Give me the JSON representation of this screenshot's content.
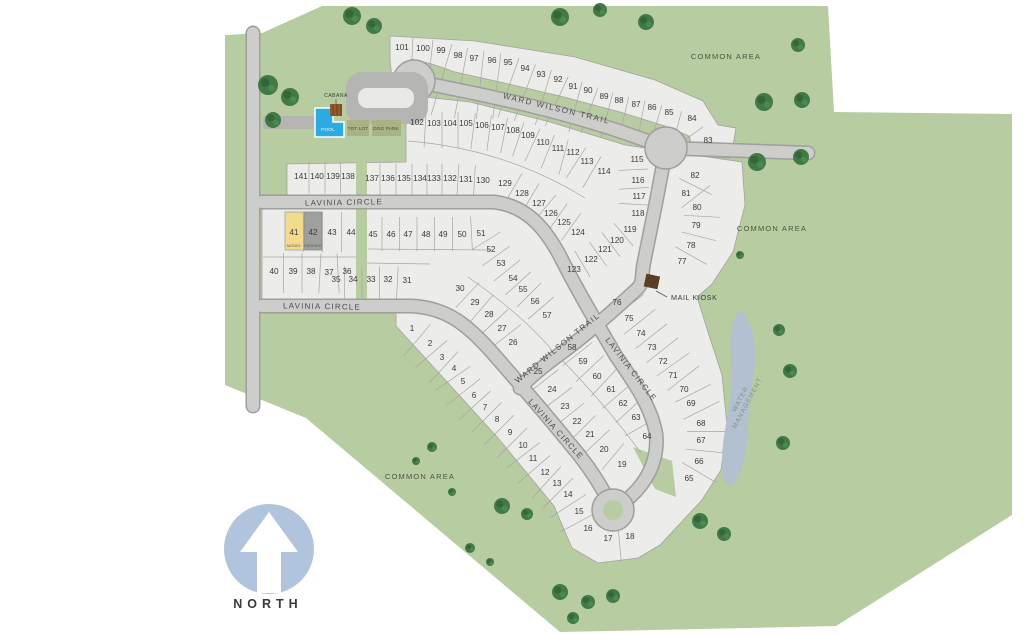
{
  "map": {
    "north_label": "NORTH",
    "streets": [
      {
        "id": "ward-wilson-trail-top",
        "text": "WARD WILSON TRAIL",
        "x": 556,
        "y": 111,
        "rot": 13.5,
        "size": 8,
        "ls": 1.6
      },
      {
        "id": "ward-wilson-trail-diagonal",
        "text": "WARD WILSON TRAIL",
        "x": 559,
        "y": 350,
        "rot": -39,
        "size": 8,
        "ls": 1.4
      },
      {
        "id": "lavinia-circle-upper",
        "text": "LAVINIA CIRCLE",
        "x": 344,
        "y": 205,
        "rot": -1,
        "size": 8,
        "ls": 1.2
      },
      {
        "id": "lavinia-circle-lower",
        "text": "LAVINIA CIRCLE",
        "x": 322,
        "y": 309,
        "rot": 1,
        "size": 8,
        "ls": 1.2
      },
      {
        "id": "lavinia-circle-southeast",
        "text": "LAVINIA CIRCLE",
        "x": 629,
        "y": 371,
        "rot": 52,
        "size": 8,
        "ls": 1.2
      },
      {
        "id": "lavinia-circle-southwest",
        "text": "LAVINIA CIRCLE",
        "x": 554,
        "y": 431,
        "rot": 48,
        "size": 8,
        "ls": 1.2
      }
    ],
    "areas": [
      {
        "id": "common-area-top-right",
        "text": "COMMON AREA",
        "x": 726,
        "y": 59,
        "size": 7.5,
        "ls": 1.2,
        "fill": "#4d553f"
      },
      {
        "id": "common-area-right",
        "text": "COMMON AREA",
        "x": 772,
        "y": 231,
        "size": 7.5,
        "ls": 1.2,
        "fill": "#4d553f"
      },
      {
        "id": "common-area-bottom-left",
        "text": "COMMON AREA",
        "x": 420,
        "y": 479,
        "size": 7.5,
        "ls": 1.2,
        "fill": "#4d553f"
      }
    ],
    "water_label": {
      "id": "water-management",
      "lines": [
        "WATER",
        "MANAGEMENT"
      ],
      "x": 742,
      "y": 400,
      "rot": -62,
      "size": 6.5,
      "ls": 1,
      "fill": "#7e948c"
    },
    "point_labels": [
      {
        "id": "cabana-label",
        "text": "CABANA",
        "x": 336,
        "y": 97,
        "size": 5,
        "fill": "#3c3c3c",
        "ls": 0.5
      },
      {
        "id": "pool-label",
        "text": "POOL",
        "x": 328,
        "y": 131,
        "size": 4.6,
        "fill": "#ffffff",
        "ls": 0.3
      },
      {
        "id": "tot-lot-label",
        "text": "TOT LOT",
        "x": 358,
        "y": 130,
        "size": 4.6,
        "fill": "#42492e",
        "ls": 0.2
      },
      {
        "id": "dog-park-label",
        "text": "DOG PARK",
        "x": 386,
        "y": 130,
        "size": 4.6,
        "fill": "#42492e",
        "ls": 0.2
      },
      {
        "id": "mail-kiosk-label",
        "text": "MAIL KIOSK",
        "x": 671,
        "y": 300,
        "size": 7.2,
        "fill": "#3b3b3b",
        "ls": 0.6,
        "anchor": "start"
      },
      {
        "id": "model-label",
        "text": "MODEL",
        "x": 294,
        "y": 247,
        "size": 4,
        "fill": "#5f5f57",
        "ls": 0
      },
      {
        "id": "parking-label",
        "text": "PARKING",
        "x": 313,
        "y": 247,
        "size": 4,
        "fill": "#5f5f57",
        "ls": 0
      },
      {
        "id": "north-label",
        "text": "NORTH",
        "x": 268,
        "y": 608,
        "size": 12.5,
        "fill": "#3a3a3a",
        "ls": 5,
        "bold": true
      }
    ],
    "lot_bands": [
      {
        "id": "north-row",
        "len": [
          80,
          32
        ],
        "off": 0.12,
        "lots": [
          [
            "101",
            402,
            47
          ],
          [
            "100",
            423,
            48
          ],
          [
            "99",
            441,
            50
          ],
          [
            "98",
            458,
            55
          ],
          [
            "97",
            474,
            58
          ],
          [
            "96",
            492,
            60
          ],
          [
            "95",
            508,
            62
          ],
          [
            "94",
            525,
            68
          ],
          [
            "93",
            541,
            74
          ],
          [
            "92",
            558,
            79
          ],
          [
            "91",
            573,
            86
          ],
          [
            "90",
            588,
            90
          ],
          [
            "89",
            604,
            96
          ],
          [
            "88",
            619,
            100
          ],
          [
            "87",
            636,
            104
          ],
          [
            "86",
            652,
            107
          ],
          [
            "85",
            669,
            112
          ],
          [
            "84",
            692,
            118
          ],
          [
            "83",
            708,
            140
          ]
        ]
      },
      {
        "id": "second-row",
        "len": 36,
        "off": 0.3,
        "lots": [
          [
            "102",
            417,
            122
          ],
          [
            "103",
            434,
            123
          ],
          [
            "104",
            450,
            123
          ],
          [
            "105",
            466,
            123
          ],
          [
            "106",
            482,
            125
          ],
          [
            "107",
            498,
            127
          ],
          [
            "108",
            513,
            130
          ],
          [
            "109",
            528,
            135
          ],
          [
            "110",
            543,
            142
          ],
          [
            "111",
            558,
            148
          ],
          [
            "112",
            573,
            152
          ],
          [
            "113",
            587,
            161
          ],
          [
            "114",
            604,
            171
          ]
        ]
      },
      {
        "id": "row-141-138",
        "len": 32,
        "off": 0.45,
        "lots": [
          [
            "141",
            301,
            176
          ],
          [
            "140",
            317,
            176
          ],
          [
            "139",
            333,
            176
          ],
          [
            "138",
            348,
            176
          ]
        ]
      },
      {
        "id": "row-137-130",
        "len": 32,
        "off": 0.45,
        "lots": [
          [
            "137",
            372,
            178
          ],
          [
            "136",
            388,
            178
          ],
          [
            "135",
            404,
            178
          ],
          [
            "134",
            420,
            178
          ],
          [
            "133",
            434,
            178
          ],
          [
            "132",
            450,
            178
          ],
          [
            "131",
            466,
            179
          ],
          [
            "130",
            483,
            180
          ]
        ]
      },
      {
        "id": "fan-129-124",
        "len": 34,
        "off": 0.5,
        "lots": [
          [
            "129",
            505,
            183
          ],
          [
            "128",
            522,
            193
          ],
          [
            "127",
            539,
            203
          ],
          [
            "126",
            551,
            213
          ],
          [
            "125",
            564,
            222
          ],
          [
            "124",
            578,
            232
          ]
        ]
      },
      {
        "id": "fan-123-119",
        "len": 30,
        "off": 0.5,
        "lots": [
          [
            "123",
            574,
            269
          ],
          [
            "122",
            591,
            259
          ],
          [
            "121",
            605,
            249
          ],
          [
            "120",
            617,
            240
          ],
          [
            "119",
            630,
            229
          ]
        ]
      },
      {
        "id": "col-115-118",
        "len": 30,
        "off": 0.35,
        "lots": [
          [
            "115",
            637,
            159
          ],
          [
            "116",
            638,
            180
          ],
          [
            "117",
            639,
            196
          ],
          [
            "118",
            638,
            213
          ]
        ]
      },
      {
        "id": "col-82-77",
        "len": 36,
        "off": 0.35,
        "flip": true,
        "lots": [
          [
            "82",
            695,
            175
          ],
          [
            "81",
            686,
            193
          ],
          [
            "80",
            697,
            207
          ],
          [
            "79",
            696,
            225
          ],
          [
            "78",
            691,
            245
          ],
          [
            "77",
            682,
            261
          ]
        ]
      },
      {
        "id": "arc-76-65",
        "len": 40,
        "off": 0.35,
        "flip": true,
        "lots": [
          [
            "76",
            617,
            302
          ],
          [
            "75",
            629,
            318
          ],
          [
            "74",
            641,
            333
          ],
          [
            "73",
            652,
            347
          ],
          [
            "72",
            663,
            361
          ],
          [
            "71",
            673,
            375
          ],
          [
            "70",
            684,
            389
          ],
          [
            "69",
            691,
            403
          ],
          [
            "68",
            701,
            423
          ],
          [
            "67",
            701,
            440
          ],
          [
            "66",
            699,
            461
          ],
          [
            "65",
            689,
            478
          ]
        ]
      },
      {
        "id": "band-45-57",
        "len": 34,
        "off": 0.5,
        "lots": [
          [
            "45",
            373,
            234
          ],
          [
            "46",
            391,
            234
          ],
          [
            "47",
            408,
            234
          ],
          [
            "48",
            426,
            234
          ],
          [
            "49",
            443,
            234
          ],
          [
            "50",
            462,
            234
          ],
          [
            "51",
            481,
            233
          ],
          [
            "52",
            491,
            249
          ],
          [
            "53",
            501,
            263
          ],
          [
            "54",
            513,
            278
          ],
          [
            "55",
            523,
            289
          ],
          [
            "56",
            535,
            301
          ],
          [
            "57",
            547,
            315
          ]
        ]
      },
      {
        "id": "band-58-64",
        "len": 38,
        "off": 0.5,
        "lots": [
          [
            "58",
            572,
            347
          ],
          [
            "59",
            583,
            361
          ],
          [
            "60",
            597,
            376
          ],
          [
            "61",
            611,
            389
          ],
          [
            "62",
            623,
            403
          ],
          [
            "63",
            636,
            417
          ],
          [
            "64",
            647,
            436
          ]
        ]
      },
      {
        "id": "band-25-19",
        "len": 34,
        "off": 0.5,
        "lots": [
          [
            "25",
            538,
            371
          ],
          [
            "24",
            552,
            389
          ],
          [
            "23",
            565,
            406
          ],
          [
            "22",
            577,
            421
          ],
          [
            "21",
            590,
            434
          ],
          [
            "20",
            604,
            449
          ],
          [
            "19",
            622,
            464
          ]
        ]
      },
      {
        "id": "band-30-26",
        "len": 34,
        "off": 0.5,
        "lots": [
          [
            "30",
            460,
            288
          ],
          [
            "29",
            475,
            302
          ],
          [
            "28",
            489,
            314
          ],
          [
            "27",
            502,
            328
          ],
          [
            "26",
            513,
            342
          ]
        ]
      },
      {
        "id": "row-35-31",
        "len": 32,
        "off": 0.4,
        "lots": [
          [
            "35",
            336,
            279
          ],
          [
            "34",
            353,
            279
          ],
          [
            "33",
            371,
            279
          ],
          [
            "32",
            388,
            279
          ],
          [
            "31",
            407,
            280
          ]
        ]
      },
      {
        "id": "row-40-36",
        "len": 40,
        "off": 0.45,
        "lots": [
          [
            "40",
            274,
            271
          ],
          [
            "39",
            293,
            271
          ],
          [
            "38",
            311,
            271
          ],
          [
            "37",
            329,
            272
          ],
          [
            "36",
            347,
            271
          ]
        ]
      },
      {
        "id": "row-41-44",
        "len": 40,
        "off": 0.5,
        "lots": [
          [
            "41",
            294,
            232
          ],
          [
            "42",
            313,
            232
          ],
          [
            "43",
            332,
            232
          ],
          [
            "44",
            351,
            232
          ]
        ]
      },
      {
        "id": "band-1-16",
        "len": 42,
        "off": 0.35,
        "lots": [
          [
            "1",
            412,
            328
          ],
          [
            "2",
            430,
            343
          ],
          [
            "3",
            442,
            357
          ],
          [
            "4",
            454,
            368
          ],
          [
            "5",
            463,
            381
          ],
          [
            "6",
            474,
            395
          ],
          [
            "7",
            485,
            407
          ],
          [
            "8",
            497,
            419
          ],
          [
            "9",
            510,
            432
          ],
          [
            "10",
            523,
            445
          ],
          [
            "11",
            533,
            458
          ],
          [
            "12",
            545,
            472
          ],
          [
            "13",
            557,
            483
          ],
          [
            "14",
            568,
            494
          ],
          [
            "15",
            579,
            511
          ],
          [
            "16",
            588,
            528
          ]
        ]
      },
      {
        "id": "band-17-18",
        "len": 30,
        "off": 0.2,
        "lots": [
          [
            "17",
            608,
            538
          ],
          [
            "18",
            630,
            536
          ]
        ]
      }
    ],
    "trees": [
      [
        352,
        16,
        9
      ],
      [
        374,
        26,
        8
      ],
      [
        268,
        85,
        10
      ],
      [
        290,
        97,
        9
      ],
      [
        273,
        120,
        8
      ],
      [
        560,
        17,
        9
      ],
      [
        600,
        10,
        7
      ],
      [
        646,
        22,
        8
      ],
      [
        798,
        45,
        7
      ],
      [
        764,
        102,
        9
      ],
      [
        802,
        100,
        8
      ],
      [
        757,
        162,
        9
      ],
      [
        801,
        157,
        8
      ],
      [
        779,
        330,
        6
      ],
      [
        790,
        371,
        7
      ],
      [
        783,
        443,
        7
      ],
      [
        700,
        521,
        8
      ],
      [
        724,
        534,
        7
      ],
      [
        502,
        506,
        8
      ],
      [
        527,
        514,
        6
      ],
      [
        560,
        592,
        8
      ],
      [
        588,
        602,
        7
      ],
      [
        613,
        596,
        7
      ],
      [
        432,
        447,
        5
      ],
      [
        416,
        461,
        4
      ],
      [
        452,
        492,
        4
      ],
      [
        573,
        618,
        6
      ],
      [
        470,
        548,
        5
      ],
      [
        490,
        562,
        4
      ],
      [
        740,
        255,
        4
      ]
    ],
    "colors": {
      "site_green": "#b7cca1",
      "lot_fill": "#ececE8",
      "lot_stroke": "#a3a39e",
      "road_fill": "#cdcdcb",
      "road_casing": "#9e9e9c",
      "pond": "#b3c0cf",
      "pool_blue": "#2aabe2",
      "model_lot_yellow": "#f2da8e",
      "parking_lot_gray": "#9f9f9d",
      "amenity_gray": "#b5b5b3",
      "north_circle_blue": "#b0c5dd",
      "tree_green": "#417a47",
      "kiosk_brown": "#5b3d24",
      "cabana_brown": "#96572e"
    }
  }
}
